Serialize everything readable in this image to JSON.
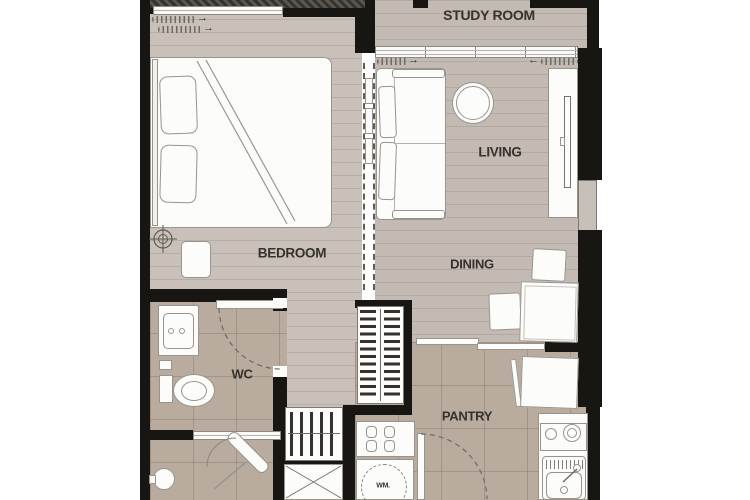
{
  "rooms": {
    "study_room": {
      "label": "STUDY ROOM"
    },
    "living": {
      "label": "LIVING"
    },
    "bedroom": {
      "label": "BEDROOM"
    },
    "dining": {
      "label": "DINING"
    },
    "wc": {
      "label": "WC"
    },
    "pantry": {
      "label": "PANTRY"
    }
  },
  "appliances": {
    "washing_machine": {
      "label": "WM."
    }
  },
  "symbols": {
    "slide_right_arrow": "→",
    "slide_left_arrow": "←"
  },
  "colors": {
    "wall": "#181613",
    "wood_floor": "#c9c1b9",
    "wood_floor_dark": "#c3bbb3",
    "tile_floor": "#b9ab9e",
    "furniture": "#fcfcfb",
    "furniture_outline": "#98948d",
    "label_text": "#35322c",
    "balcony_hatch": "#5b5650"
  }
}
